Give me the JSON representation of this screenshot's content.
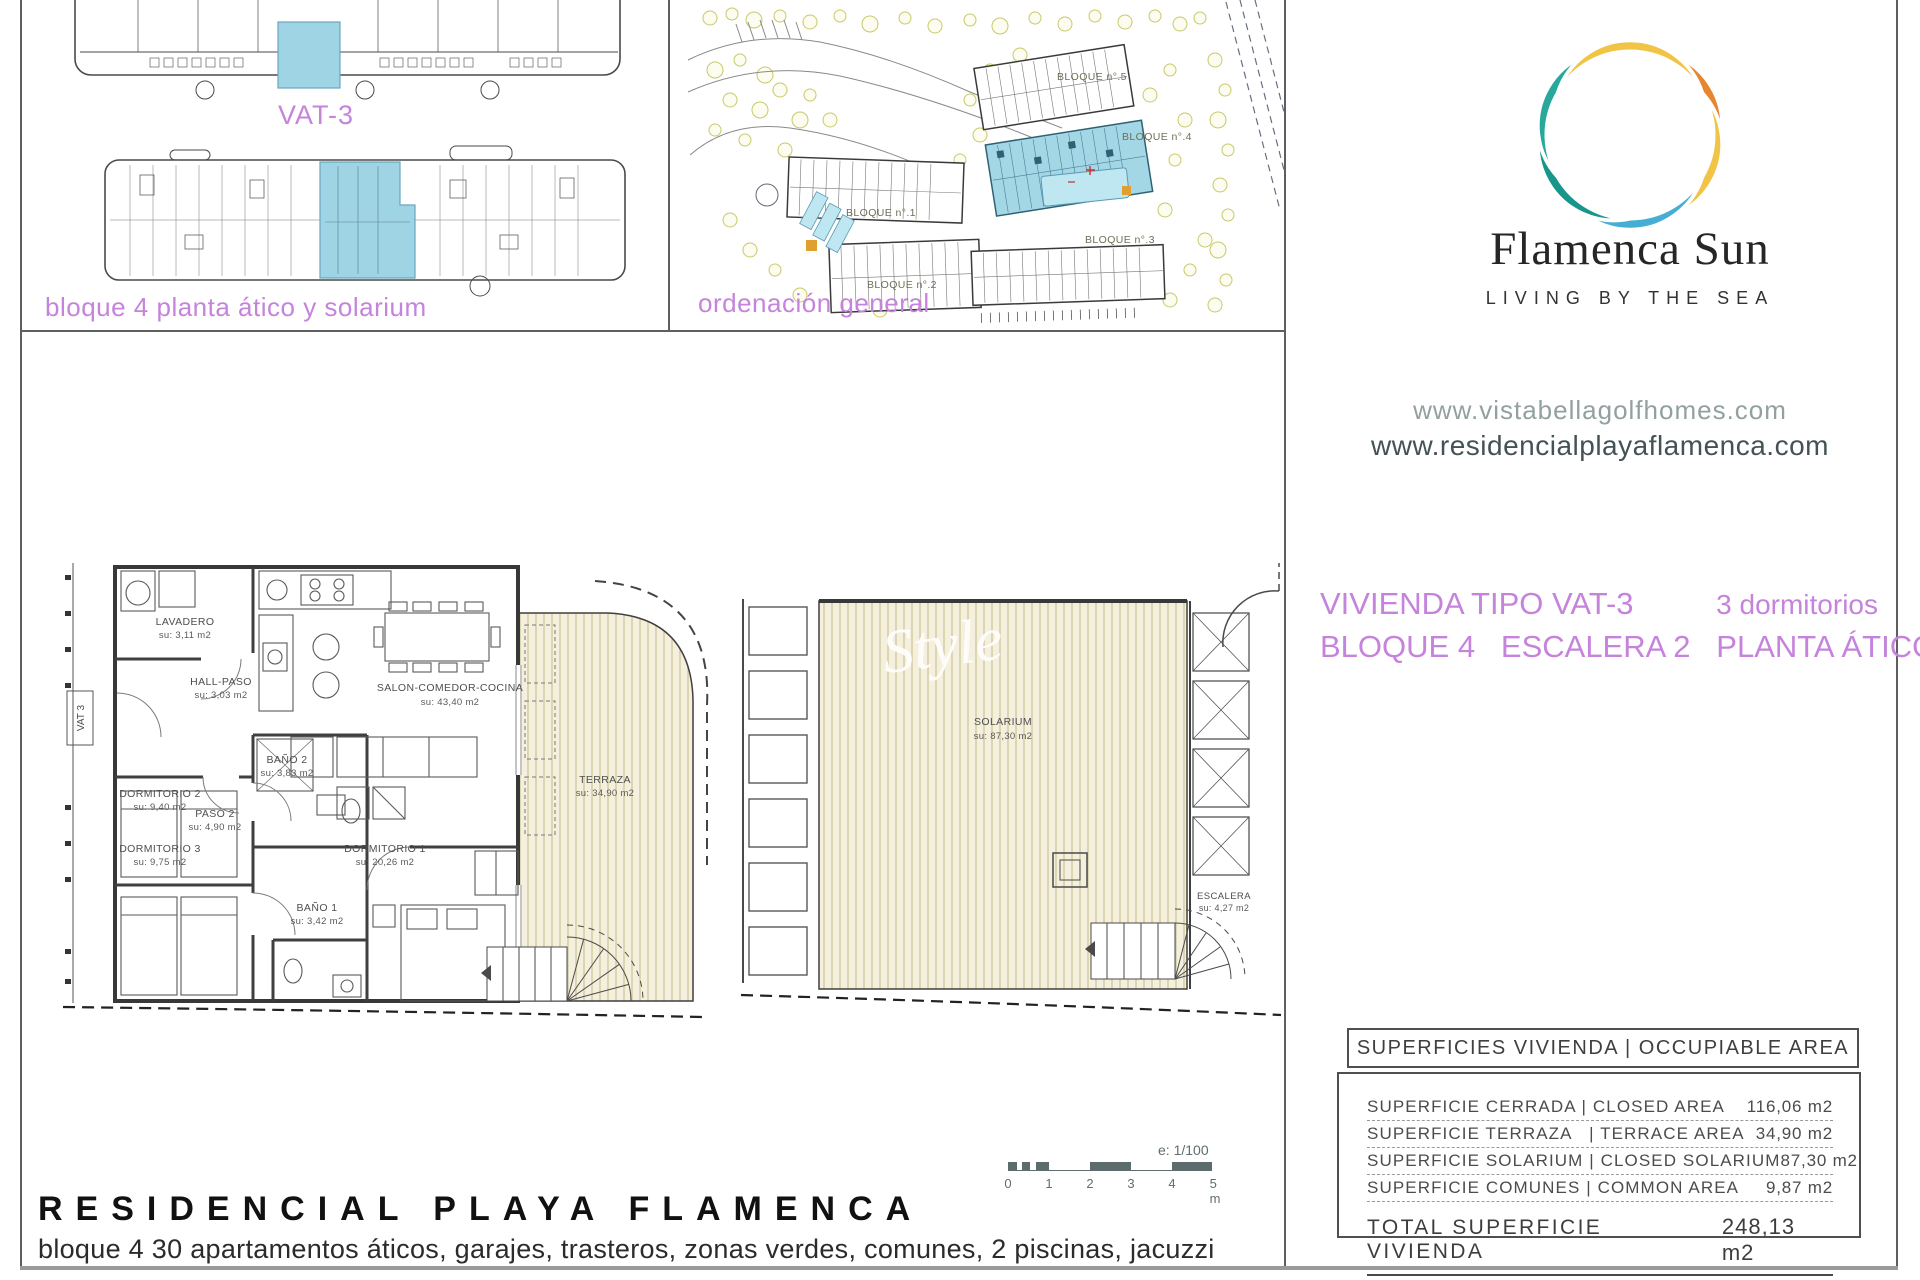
{
  "panel_block_plans": {
    "unit_tag": "VAT-3",
    "caption": "bloque 4 planta ático y solarium"
  },
  "panel_site_plan": {
    "caption": "ordenación general",
    "block_labels": [
      "BLOQUE n°.5",
      "BLOQUE n°.4",
      "BLOQUE n°.1",
      "BLOQUE n°.2",
      "BLOQUE n°.3"
    ]
  },
  "brand": {
    "name": "Flamenca Sun",
    "tagline": "LIVING BY THE SEA",
    "websites": [
      "www.vistabellagolfhomes.com",
      "www.residencialplayaflamenca.com"
    ],
    "colors": {
      "orange": "#e6872f",
      "yellow": "#f2c445",
      "blue": "#47aed3",
      "teal": "#18968c",
      "teal_light": "#27a89b",
      "purple": "#c583dc",
      "highlight_blue": "#9fd4e4"
    }
  },
  "unit_header": {
    "type_label": "VIVIENDA TIPO VAT-3",
    "bedrooms": "3 dormitorios",
    "location_line": "BLOQUE 4   ESCALERA 2   PLANTA ÁTICO"
  },
  "apartment_plan": {
    "entry_tag": "VAT 3",
    "rooms": [
      {
        "name": "LAVADERO",
        "area": "su: 3,11 m2"
      },
      {
        "name": "HALL-PASO",
        "area": "su: 3,03 m2"
      },
      {
        "name": "SALON-COMEDOR-COCINA",
        "area": "su: 43,40 m2"
      },
      {
        "name": "BAÑO 2",
        "area": "su: 3,83 m2"
      },
      {
        "name": "PASO 2",
        "area": "su: 4,90 m2"
      },
      {
        "name": "DORMITORIO 2",
        "area": "su: 9,40 m2"
      },
      {
        "name": "DORMITORIO 3",
        "area": "su: 9,75 m2"
      },
      {
        "name": "DORMITORIO 1",
        "area": "su: 20,26 m2"
      },
      {
        "name": "BAÑO 1",
        "area": "su: 3,42 m2"
      },
      {
        "name": "TERRAZA",
        "area": "su: 34,90 m2"
      }
    ]
  },
  "solarium_plan": {
    "rooms": [
      {
        "name": "SOLARIUM",
        "area": "su: 87,30 m2"
      },
      {
        "name": "ESCALERA",
        "area": "su: 4,27 m2"
      }
    ],
    "watermark": "Style"
  },
  "scale_bar": {
    "scale_text": "e: 1/100",
    "ticks": [
      "0",
      "1",
      "2",
      "3",
      "4",
      "5 m"
    ]
  },
  "areas_table": {
    "header": "SUPERFICIES VIVIENDA | OCCUPIABLE AREA",
    "rows": [
      {
        "label": "SUPERFICIE CERRADA | CLOSED AREA",
        "value": "116,06 m2"
      },
      {
        "label": "SUPERFICIE TERRAZA   | TERRACE AREA",
        "value": "34,90 m2"
      },
      {
        "label": "SUPERFICIE SOLARIUM | CLOSED SOLARIUM",
        "value": "87,30 m2"
      },
      {
        "label": "SUPERFICIE COMUNES | COMMON AREA",
        "value": "9,87 m2"
      }
    ],
    "total": {
      "label": "TOTAL SUPERFICIE VIVIENDA",
      "value": "248,13 m2"
    }
  },
  "footer": {
    "title": "RESIDENCIAL PLAYA FLAMENCA",
    "subtitle": "bloque 4 30 apartamentos áticos, garajes, trasteros, zonas verdes, comunes, 2 piscinas, jacuzzi"
  }
}
